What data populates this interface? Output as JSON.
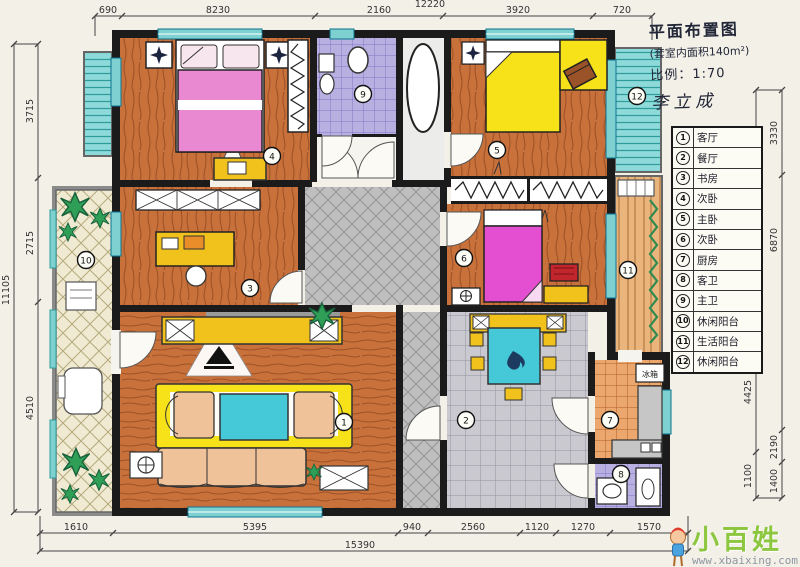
{
  "title_block": {
    "line1": "平面布置图",
    "line2": "(套室内面积140m²)",
    "line3": "比例：1:70",
    "line4": "李立成"
  },
  "legend": {
    "rows": [
      {
        "num": "1",
        "label": "客厅"
      },
      {
        "num": "2",
        "label": "餐厅"
      },
      {
        "num": "3",
        "label": "书房"
      },
      {
        "num": "4",
        "label": "次卧"
      },
      {
        "num": "5",
        "label": "主卧"
      },
      {
        "num": "6",
        "label": "次卧"
      },
      {
        "num": "7",
        "label": "厨房"
      },
      {
        "num": "8",
        "label": "客卫"
      },
      {
        "num": "9",
        "label": "主卫"
      },
      {
        "num": "10",
        "label": "休闲阳台"
      },
      {
        "num": "11",
        "label": "生活阳台"
      },
      {
        "num": "12",
        "label": "休闲阳台"
      }
    ]
  },
  "rooms": {
    "living": {
      "num": "1"
    },
    "dining": {
      "num": "2"
    },
    "study": {
      "num": "3"
    },
    "bedroom_tl": {
      "num": "4"
    },
    "bedroom_tr": {
      "num": "5"
    },
    "bedroom_mr": {
      "num": "6"
    },
    "kitchen": {
      "num": "7",
      "appliance_label": "冰箱"
    },
    "bath_guest": {
      "num": "8"
    },
    "bath_master": {
      "num": "9"
    },
    "balcony_left": {
      "num": "10"
    },
    "balcony_right": {
      "num": "11"
    },
    "balcony_top": {
      "num": "12"
    }
  },
  "dimensions": {
    "top": {
      "overall": "12220",
      "segments": [
        "690",
        "8230",
        "2160",
        "3920",
        "720"
      ]
    },
    "bottom": {
      "overall": "15390",
      "segments": [
        "1610",
        "5395",
        "940",
        "2560",
        "1120",
        "1270",
        "1570"
      ]
    },
    "left": {
      "overall": "11105",
      "segments": [
        "3715",
        "2715",
        "4510"
      ]
    },
    "right_inner": {
      "segments": [
        "3540",
        "1495",
        "4425",
        "1100"
      ]
    },
    "right_outer": {
      "segments": [
        "3330",
        "6870",
        "2190",
        "1400"
      ]
    }
  },
  "watermark": {
    "name": "小百姓",
    "url": "www.xbaixing.com"
  },
  "palette": {
    "wood": "#c9713b",
    "accent_yellow": "#f2c21c",
    "bed_pink": "#e989d2",
    "bed_magenta": "#e34fd0",
    "bed_yellow": "#f7e21a",
    "table_cyan": "#45c8d8",
    "tile_lavender": "#b9b0e2",
    "window_teal": "#7fd0d0",
    "tile_gray": "#c9c9cf",
    "tile_orange": "#eca76e",
    "plant_green": "#2f9e57",
    "watermark_green": "#8dc63f",
    "wall_black": "#1b1b1b"
  }
}
